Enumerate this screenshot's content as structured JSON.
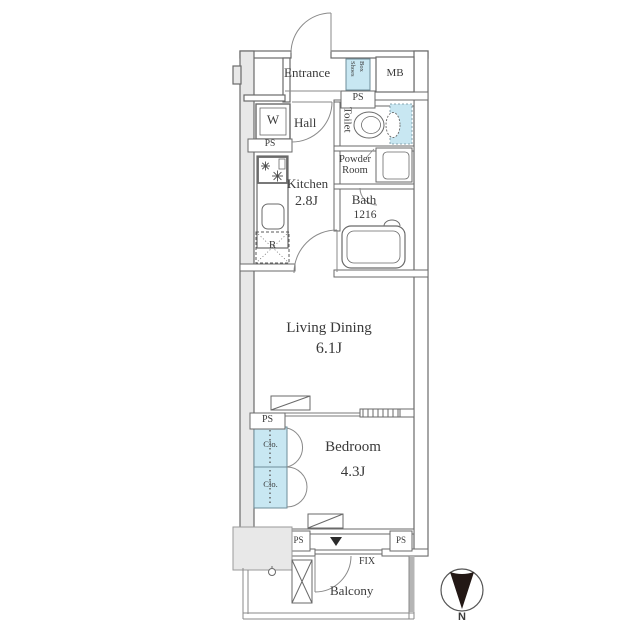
{
  "floorplan": {
    "title_hint": "apartment floor plan",
    "rooms": {
      "entrance": "Entrance",
      "shoes_box_line1": "Shoes",
      "shoes_box_line2": "Box",
      "mb": "MB",
      "ps": "PS",
      "washing_machine": "W",
      "hall": "Hall",
      "toilet": "Toilet",
      "powder_room": "Powder Room",
      "kitchen": "Kitchen",
      "kitchen_size": "2.8J",
      "bath": "Bath",
      "bath_size": "1216",
      "refrigerator": "R",
      "living_dining": "Living Dining",
      "living_dining_size": "6.1J",
      "closet": "Clo.",
      "bedroom": "Bedroom",
      "bedroom_size": "4.3J",
      "fix_window": "FIX",
      "balcony": "Balcony"
    },
    "compass": {
      "north": "N",
      "direction": "down"
    },
    "colors": {
      "wall_line": "#6a6a6a",
      "wall_fill_gray": "#e8e8e8",
      "storage_cyan": "#c8e7f2",
      "text": "#3a3a3a",
      "compass_fill": "#231815"
    }
  }
}
